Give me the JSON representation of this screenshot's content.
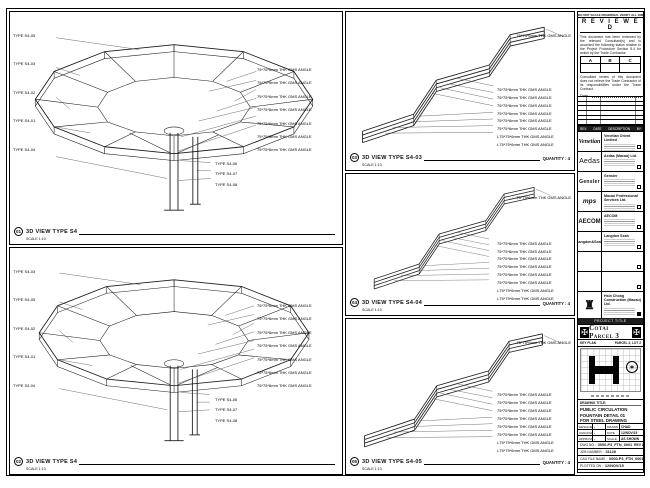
{
  "sheet": {
    "top_note": "DO NOT SCALE DRAWINGS. VERIFY ALL DIMENSIONS ON SITE."
  },
  "stamp": {
    "title": "R E V I E W E D",
    "body1": "This document has been reviewed by the relevant Consultant(s) and is accorded the following status relative to the Project Procedure Section 5.4 for action by the Trade Contractor.",
    "options": [
      "A",
      "B",
      "C"
    ],
    "body2": "Consultant review of this document does not relieve the Trade Contractor of its responsibilities under the Trade Contract.",
    "date_label": "Date :"
  },
  "rev_table": {
    "headers": [
      "REV",
      "DATE",
      "DESCRIPTION",
      "BY"
    ]
  },
  "consultants": [
    {
      "logo": "Venetian",
      "name": "Venetian Orient Limited"
    },
    {
      "logo": "Aedas",
      "name": "Aedas (Macau) Ltd."
    },
    {
      "logo": "Gensler",
      "name": "Gensler"
    },
    {
      "logo": "mps",
      "name": "Macau Professional Services Ltd."
    },
    {
      "logo": "AECOM",
      "name": "AECOM"
    },
    {
      "logo": "Langdon&Seah",
      "name": "Langdon Seah"
    },
    {
      "logo": "",
      "name": ""
    },
    {
      "logo": "",
      "name": ""
    },
    {
      "logo": "♜",
      "name": "Hsin Chong Construction (Macau) Ltd."
    }
  ],
  "project": {
    "band_label": "PROJECT TITLE",
    "name": "Cotai Parcel 3"
  },
  "key_plan": {
    "label": "KEY PLAN",
    "zone": "PARCEL 3, LOT 2",
    "compass_icon": "✶",
    "emblem_icon": "✠"
  },
  "drawing_title": {
    "label": "DRAWING TITLE:",
    "line1": "PUBLIC CIRCULATION",
    "line2": "FOUNTAIN DETAIL 01",
    "line3": "FOR STEEL DRAWING"
  },
  "fields": {
    "designed_label": "DESIGNED",
    "designed": "-",
    "drawn_label": "DRAWN",
    "drawn": "CHAD",
    "checked_label": "CHECKED",
    "checked": "-",
    "date_label": "DATE",
    "date": "12/NOV/15",
    "approved_label": "APPROVED",
    "approved": "-",
    "scale_label": "SCALE",
    "scale": "AS SHOWN",
    "dwg_label": "DWG NO :",
    "dwg_no": "0000-P3_FTN_0001",
    "rev": "REV A",
    "job_label": "JOB NUMBER :",
    "job_no": "31128",
    "cad_label": "CAD FILE NAME :",
    "cad_file": "0000-P3_FTN_0001.dwg",
    "plot_label": "PLOTTED ON :",
    "plot_value": "12/NOV/15"
  },
  "panels": [
    {
      "ref": "01",
      "title": "3D VIEW TYPE S4",
      "scale": "SCALE 1:10",
      "quantity": "",
      "left_labels": [
        "TYPE S4-05",
        "TYPE S4-03",
        "TYPE S4-02",
        "TYPE S4-01",
        "TYPE S4-04"
      ],
      "right_labels": [
        "75*75*6mm THK GMS ANGLE",
        "75*75*6mm THK GMS ANGLE",
        "75*75*6mm THK GMS ANGLE",
        "75*75*6mm THK GMS ANGLE",
        "75*75*6mm THK GMS ANGLE",
        "75*75*6mm THK GMS ANGLE",
        "75*75*6mm THK GMS ANGLE"
      ],
      "bottom_labels": [
        "TYPE S4-06",
        "TYPE S4-07",
        "TYPE S4-08"
      ]
    },
    {
      "ref": "02",
      "title": "3D VIEW TYPE S4",
      "scale": "SCALE 1:10",
      "quantity": "",
      "left_labels": [
        "TYPE S4-03",
        "TYPE S4-05",
        "TYPE S4-02",
        "TYPE S4-01",
        "TYPE S4-04"
      ],
      "right_labels": [
        "75*75*6mm THK GMS ANGLE",
        "75*75*6mm THK GMS ANGLE",
        "75*75*6mm THK GMS ANGLE",
        "75*75*6mm THK GMS ANGLE",
        "75*75*6mm THK GMS ANGLE",
        "75*75*6mm THK GMS ANGLE",
        "75*75*6mm THK GMS ANGLE"
      ],
      "bottom_labels": [
        "TYPE S4-06",
        "TYPE S4-07",
        "TYPE S4-08"
      ]
    },
    {
      "ref": "03",
      "title": "3D VIEW TYPE S4-03",
      "scale": "SCALE 1:10",
      "quantity": "QUANTITY : 4",
      "top_label": "75*75*6mm THK GMS ANGLE",
      "right_labels": [
        "75*75*6mm THK GMS ANGLE",
        "75*75*6mm THK GMS ANGLE",
        "75*75*6mm THK GMS ANGLE",
        "75*75*6mm THK GMS ANGLE",
        "75*75*6mm THK GMS ANGLE",
        "75*75*6mm THK GMS ANGLE",
        "L75*75*6mm THK GMS ANGLE",
        "L75*75*6mm THK GMS ANGLE"
      ]
    },
    {
      "ref": "04",
      "title": "3D VIEW TYPE S4-04",
      "scale": "SCALE 1:10",
      "quantity": "QUANTITY : 4",
      "top_label": "75*75*6mm THK GMS ANGLE",
      "right_labels": [
        "75*75*6mm THK GMS ANGLE",
        "75*75*6mm THK GMS ANGLE",
        "75*75*6mm THK GMS ANGLE",
        "75*75*6mm THK GMS ANGLE",
        "75*75*6mm THK GMS ANGLE",
        "75*75*6mm THK GMS ANGLE",
        "L75*75*6mm THK GMS ANGLE",
        "L75*75*6mm THK GMS ANGLE"
      ]
    },
    {
      "ref": "05",
      "title": "3D VIEW TYPE S4-05",
      "scale": "SCALE 1:10",
      "quantity": "QUANTITY : 4",
      "top_label": "75*75*6mm THK GMS ANGLE",
      "right_labels": [
        "75*75*6mm THK GMS ANGLE",
        "75*75*6mm THK GMS ANGLE",
        "75*75*6mm THK GMS ANGLE",
        "75*75*6mm THK GMS ANGLE",
        "75*75*6mm THK GMS ANGLE",
        "75*75*6mm THK GMS ANGLE",
        "L75*75*6mm THK GMS ANGLE",
        "L75*75*6mm THK GMS ANGLE"
      ]
    }
  ]
}
